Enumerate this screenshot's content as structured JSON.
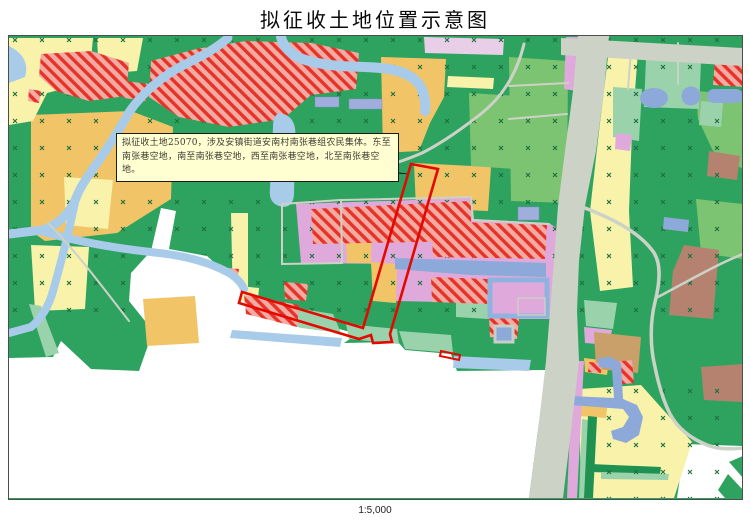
{
  "title": "拟征收土地位置示意图",
  "map": {
    "annotation": {
      "text": "拟征收土地25070，涉及安镇街道安南村南张巷组农民集体。东至南张巷空地，南至南张巷空地，西至南张巷空地，北至南张巷空地。"
    },
    "scale_label": "1:5,000",
    "colors": {
      "land-green": "#2ea360",
      "light-green": "#7cc472",
      "mint-green": "#9ad2ac",
      "dark-green-strip": "#1f9150",
      "pale-yellow": "#f8f2ab",
      "orange": "#f2c468",
      "pink": "#dfa9dc",
      "lavender": "#e9cee8",
      "hatch-pink": "#f2aba3",
      "hatch-red": "#e63228",
      "water-blue": "#a8cbe9",
      "pond-blue": "#8ca9d9",
      "building-blue": "#9faedc",
      "road-gray": "#cdd2c6",
      "brown": "#b5826f",
      "tan": "#c9a06a",
      "highlight-red": "#e50800",
      "callout-bg": "#ffffd2",
      "marker-green": "#1d6e3e"
    }
  }
}
